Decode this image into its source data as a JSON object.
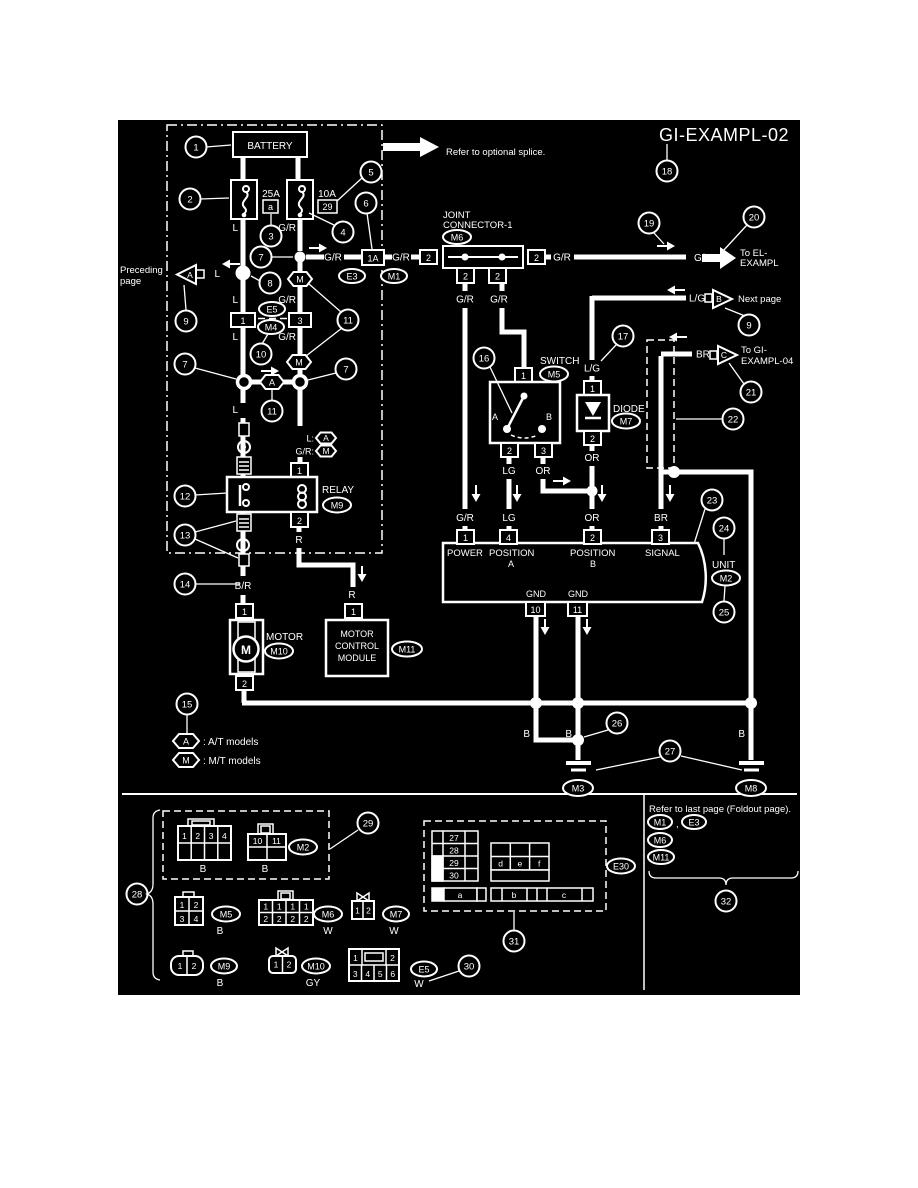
{
  "title": "GI-EXAMPL-02",
  "notes": {
    "splice": "Refer to optional splice.",
    "preceding1": "Preceding",
    "preceding2": "page",
    "next": "Next  page",
    "toel1": "To EL-",
    "toel2": "EXAMPL",
    "togi1": "To GI-",
    "togi2": "EXAMPL-04",
    "foldout": "Refer to last page (Foldout page).",
    "comma": ","
  },
  "comp": {
    "battery": "BATTERY",
    "joint1": "JOINT",
    "joint2": "CONNECTOR-1",
    "switch": "SWITCH",
    "diode": "DIODE",
    "relay": "RELAY",
    "motor": "MOTOR",
    "m": "M",
    "mcm1": "MOTOR",
    "mcm2": "CONTROL",
    "mcm3": "MODULE",
    "unit": "UNIT"
  },
  "unit": {
    "power": "POWER",
    "posa": "POSITION",
    "posa2": "A",
    "posb": "POSITION",
    "posb2": "B",
    "signal": "SIGNAL",
    "gnd": "GND"
  },
  "fuse": {
    "a_amp": "25A",
    "b_amp": "10A"
  },
  "wire": {
    "L": "L",
    "GR": "G/R",
    "LG": "L/G",
    "LGRN": "LG",
    "OR": "OR",
    "BR": "BR",
    "B": "B",
    "R": "R",
    "BRS": "B/R",
    "GY": "GY",
    "W": "W",
    "Lc": "L:",
    "GRc": "G/R:"
  },
  "conn": {
    "M1": "M1",
    "M2": "M2",
    "M3": "M3",
    "M4": "M4",
    "M5": "M5",
    "M6": "M6",
    "M7": "M7",
    "M8": "M8",
    "M9": "M9",
    "M10": "M10",
    "M11": "M11",
    "E3": "E3",
    "E5": "E5",
    "E30": "E30",
    "A1": "1A"
  },
  "t": {
    "1": "1",
    "2": "2",
    "3": "3",
    "4": "4",
    "5": "5",
    "6": "6",
    "10": "10",
    "11": "11",
    "27": "27",
    "28": "28",
    "29": "29",
    "30": "30",
    "a": "a",
    "b": "b",
    "c": "c",
    "d": "d",
    "e": "e",
    "f": "f"
  },
  "sw": {
    "A": "A",
    "B": "B"
  },
  "tri": {
    "A": "A",
    "B": "B",
    "C": "C"
  },
  "legend": {
    "A": "A",
    "M": "M",
    "at": ": A/T models",
    "mt": ": M/T models"
  },
  "c": {
    "1": "1",
    "2": "2",
    "3": "3",
    "4": "4",
    "5": "5",
    "6": "6",
    "7": "7",
    "8": "8",
    "9": "9",
    "10": "10",
    "11": "11",
    "12": "12",
    "13": "13",
    "14": "14",
    "15": "15",
    "16": "16",
    "17": "17",
    "18": "18",
    "19": "19",
    "20": "20",
    "21": "21",
    "22": "22",
    "23": "23",
    "24": "24",
    "25": "25",
    "26": "26",
    "27": "27",
    "28": "28",
    "29": "29",
    "30": "30",
    "31": "31",
    "32": "32"
  }
}
